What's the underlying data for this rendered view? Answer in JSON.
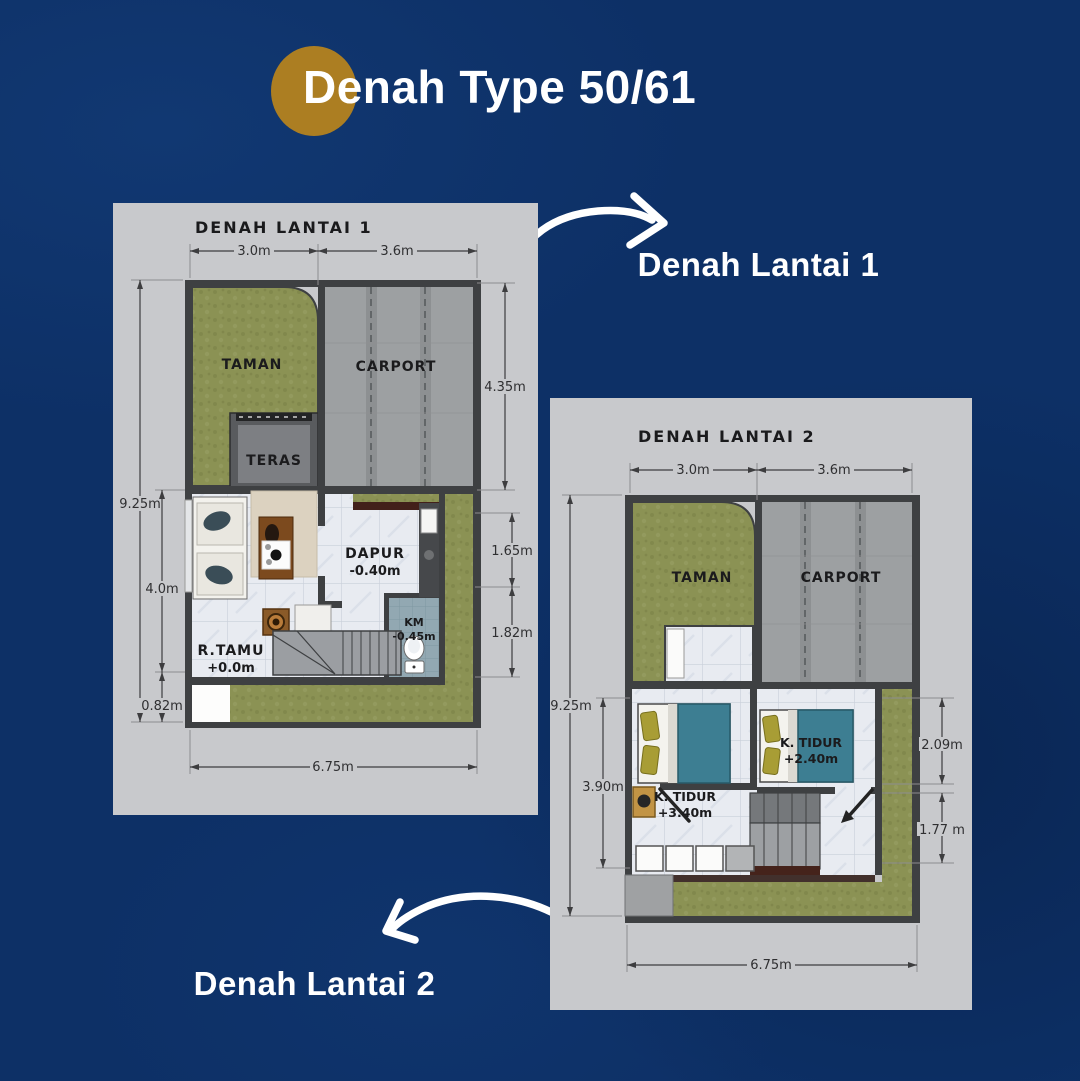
{
  "page": {
    "title": "Denah Type 50/61",
    "background_color": "#0d3066",
    "accent_circle_color": "#ac7e22"
  },
  "callouts": {
    "floor1": "Denah Lantai 1",
    "floor2": "Denah Lantai 2"
  },
  "floor1": {
    "title": "DENAH LANTAI 1",
    "rooms": {
      "taman": "TAMAN",
      "carport": "CARPORT",
      "teras": "TERAS",
      "dapur": "DAPUR",
      "dapur_level": "-0.40m",
      "km": "KM",
      "km_level": "-0.45m",
      "rtamu": "R.TAMU",
      "rtamu_level": "+0.0m"
    },
    "dims": {
      "top_left": "3.0m",
      "top_right": "3.6m",
      "right_carport": "4.35m",
      "right_mid": "1.65m",
      "right_lower": "1.82m",
      "left_total": "9.25m",
      "left_living": "4.0m",
      "left_bottom": "0.82m",
      "bottom_total": "6.75m"
    }
  },
  "floor2": {
    "title": "DENAH LANTAI 2",
    "rooms": {
      "taman": "TAMAN",
      "carport": "CARPORT",
      "bedroom1": "K. TIDUR",
      "bedroom1_level": "+3.40m",
      "bedroom2": "K. TIDUR",
      "bedroom2_level": "+2.40m"
    },
    "dims": {
      "top_left": "3.0m",
      "top_right": "3.6m",
      "left_total": "9.25m",
      "left_bedroom": "3.90m",
      "right_upper": "2.09m",
      "right_lower": "1.77 m",
      "bottom_total": "6.75m"
    }
  },
  "colors": {
    "panel": "#c8c9cc",
    "garden_green": "#8b9254",
    "carport_gray": "#9da0a2",
    "wall_dark": "#3e4042",
    "floor_tile": "#e8ebf1",
    "bathroom_tile": "#92a8b2",
    "bed_teal": "#3d7e92",
    "dim_text": "#2f2f31"
  }
}
